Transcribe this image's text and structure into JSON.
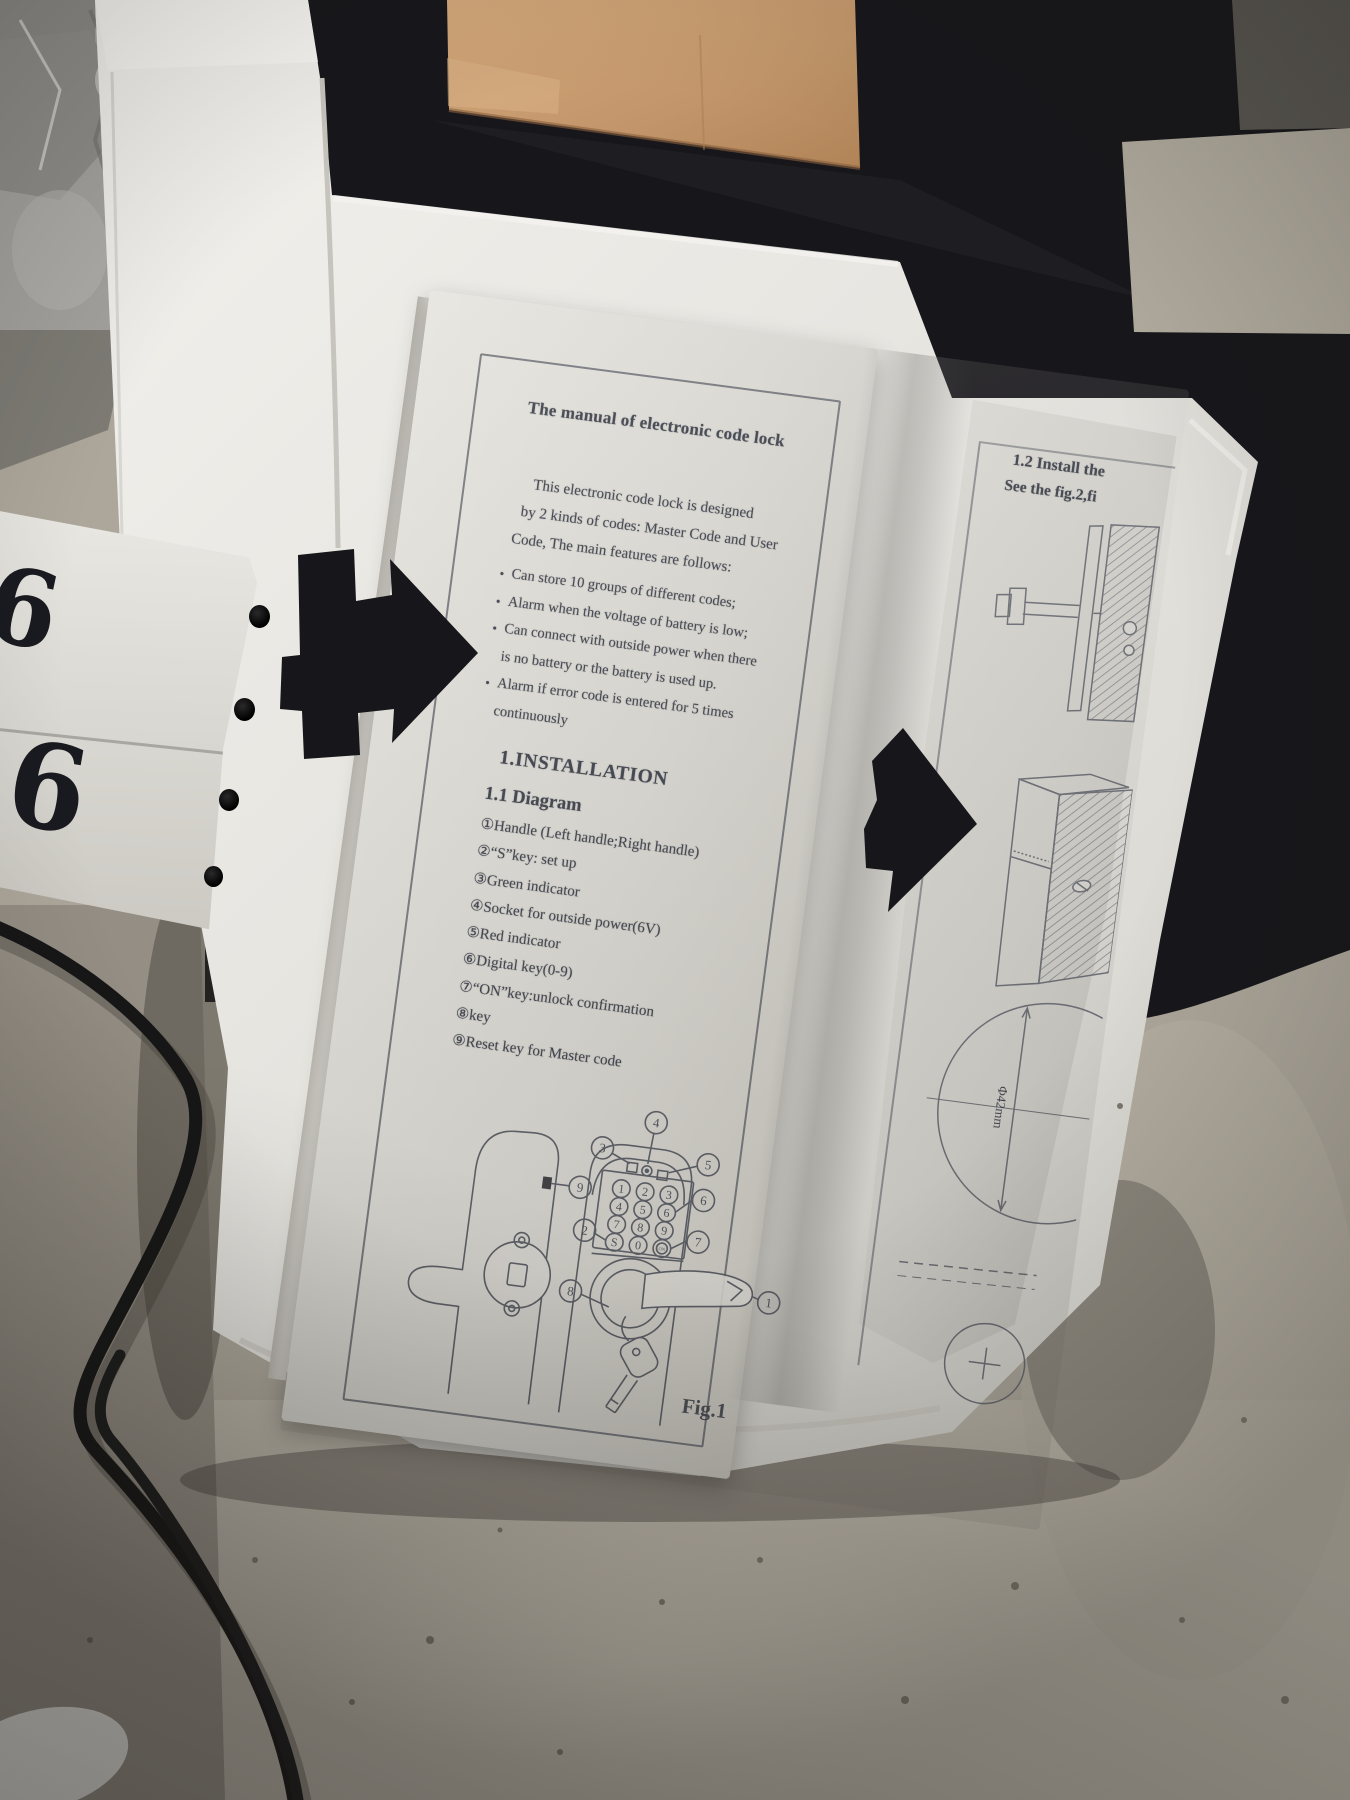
{
  "palette": {
    "floor": "#b2aca0",
    "dark_cloth": "#17161a",
    "cardboard": "#c49a6a",
    "foam": "#eae8e3",
    "paper": "#dcdad4",
    "ink": "#3a3e48",
    "arrow": "#17171b",
    "cable": "#161616"
  },
  "manual": {
    "left_page": {
      "title": "The manual of electronic code lock",
      "intro_lines": [
        "This electronic code lock is designed",
        "by 2 kinds of codes: Master Code and User",
        "Code, The main features are follows:"
      ],
      "bullet_glyph": "•",
      "bullets": [
        "Can store 10 groups of different codes;",
        "Alarm when the voltage of battery is low;",
        "Can connect with outside power when there\nis no battery or the battery is used up.",
        "Alarm if error code is entered for 5 times\ncontinuously"
      ],
      "heading1": "1.INSTALLATION",
      "heading2": "1.1 Diagram",
      "diagram_items": [
        "①Handle (Left handle;Right handle)",
        "②“S”key: set up",
        "③Green indicator",
        "④Socket for outside power(6V)",
        "⑤Red indicator",
        "⑥Digital key(0-9)",
        "⑦“ON”key:unlock confirmation",
        "⑧key",
        "⑨Reset key for Master code"
      ],
      "figure_label": "Fig.1",
      "keypad_keys": [
        "1",
        "2",
        "3",
        "4",
        "5",
        "6",
        "7",
        "8",
        "9",
        "S",
        "0",
        "ON"
      ],
      "callouts": [
        "1",
        "2",
        "3",
        "4",
        "5",
        "6",
        "7",
        "8",
        "9"
      ]
    },
    "right_page": {
      "heading_line1": "1.2 Install the",
      "heading_line2": "See the fig.2,fi",
      "dimension_label": "Φ42mm"
    }
  },
  "tag": {
    "digit_top": "6",
    "digit_bottom": "6"
  }
}
